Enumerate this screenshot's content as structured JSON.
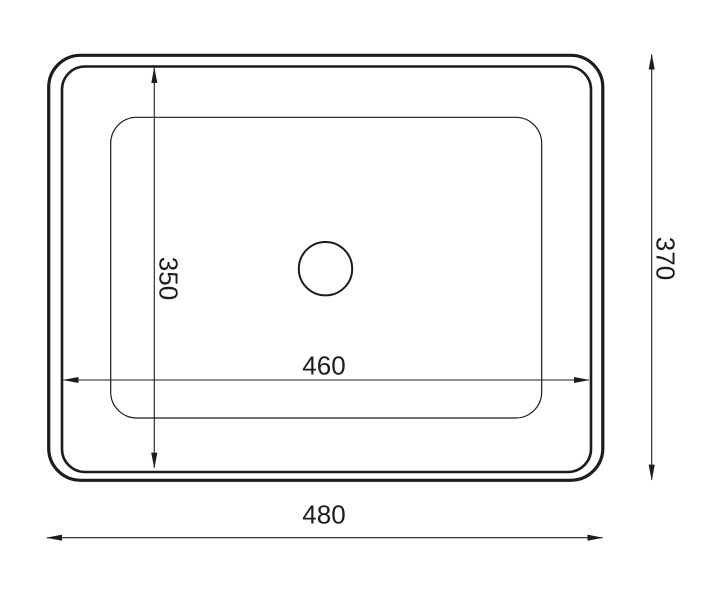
{
  "drawing": {
    "kind": "dimensioned technical drawing, top view of rectangular basin",
    "colors": {
      "line": "#1c1c1c",
      "text": "#1c1c1c",
      "background": "#ffffff"
    },
    "dimensions": {
      "inner_width": {
        "label": "460"
      },
      "inner_height": {
        "label": "350"
      },
      "overall_width": {
        "label": "480"
      },
      "overall_height": {
        "label": "370"
      }
    }
  }
}
